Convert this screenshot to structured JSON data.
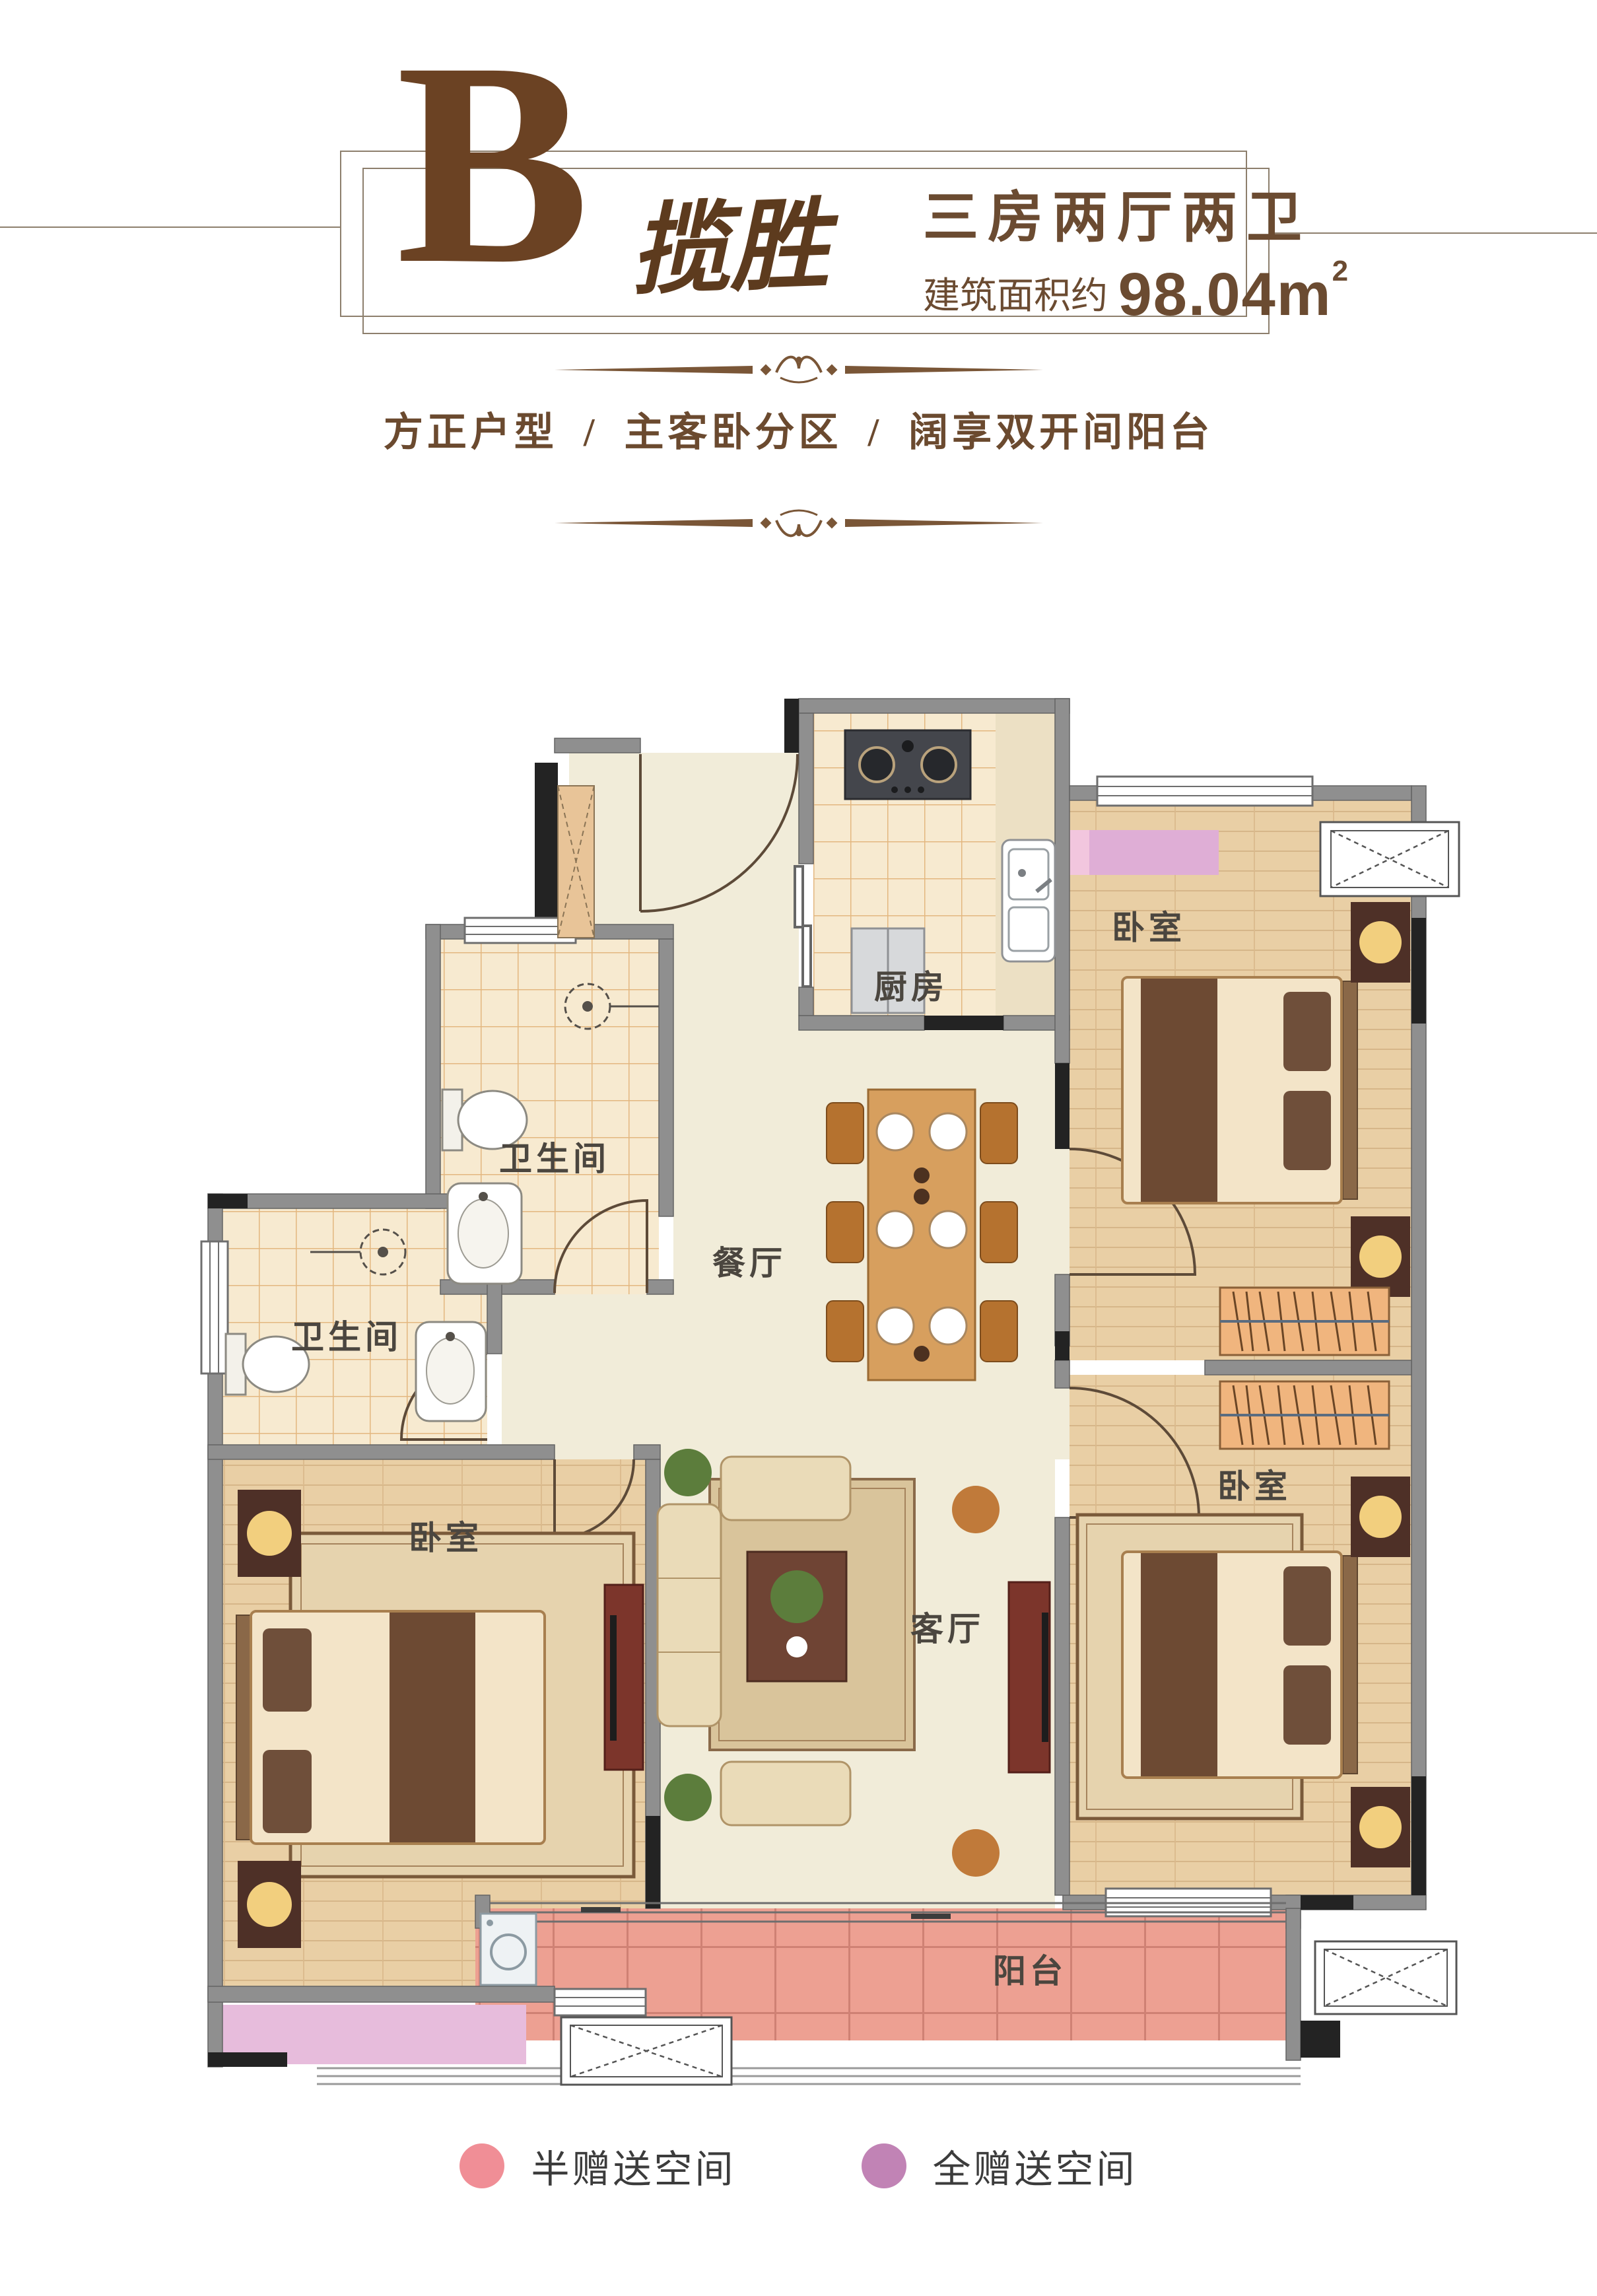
{
  "header": {
    "unit_letter": "B",
    "unit_name": "揽胜",
    "layout_title": "三房两厅两卫",
    "area_prefix": "建筑面积约",
    "area_value": "98.04m",
    "area_superscript": "2",
    "tagline": "方正户型 / 主客卧分区 / 阔享双开间阳台"
  },
  "floorplan": {
    "room_labels": {
      "kitchen": "厨房",
      "bedroom": "卧室",
      "bathroom": "卫生间",
      "dining": "餐厅",
      "living": "客厅",
      "balcony": "阳台"
    }
  },
  "legend": {
    "items": [
      {
        "label": "半赠送空间",
        "color": "#f08e96",
        "style": "background:#f08e96"
      },
      {
        "label": "全赠送空间",
        "color": "#c183b5",
        "style": "background:#c183b5"
      }
    ]
  },
  "colors": {
    "brand_brown": "#6b4223",
    "text_brown": "#6b4b31",
    "wall_gray": "#8f8f8f",
    "column_black": "#222222",
    "balcony_half_gift_pink": "#eda092",
    "full_gift_purple": "#dfaed6",
    "full_gift_lavender": "#e7bcdc",
    "wood_floor": "#e9cfa5",
    "tile_floor": "#f7ead0",
    "marble_floor": "#f1ecd9"
  }
}
